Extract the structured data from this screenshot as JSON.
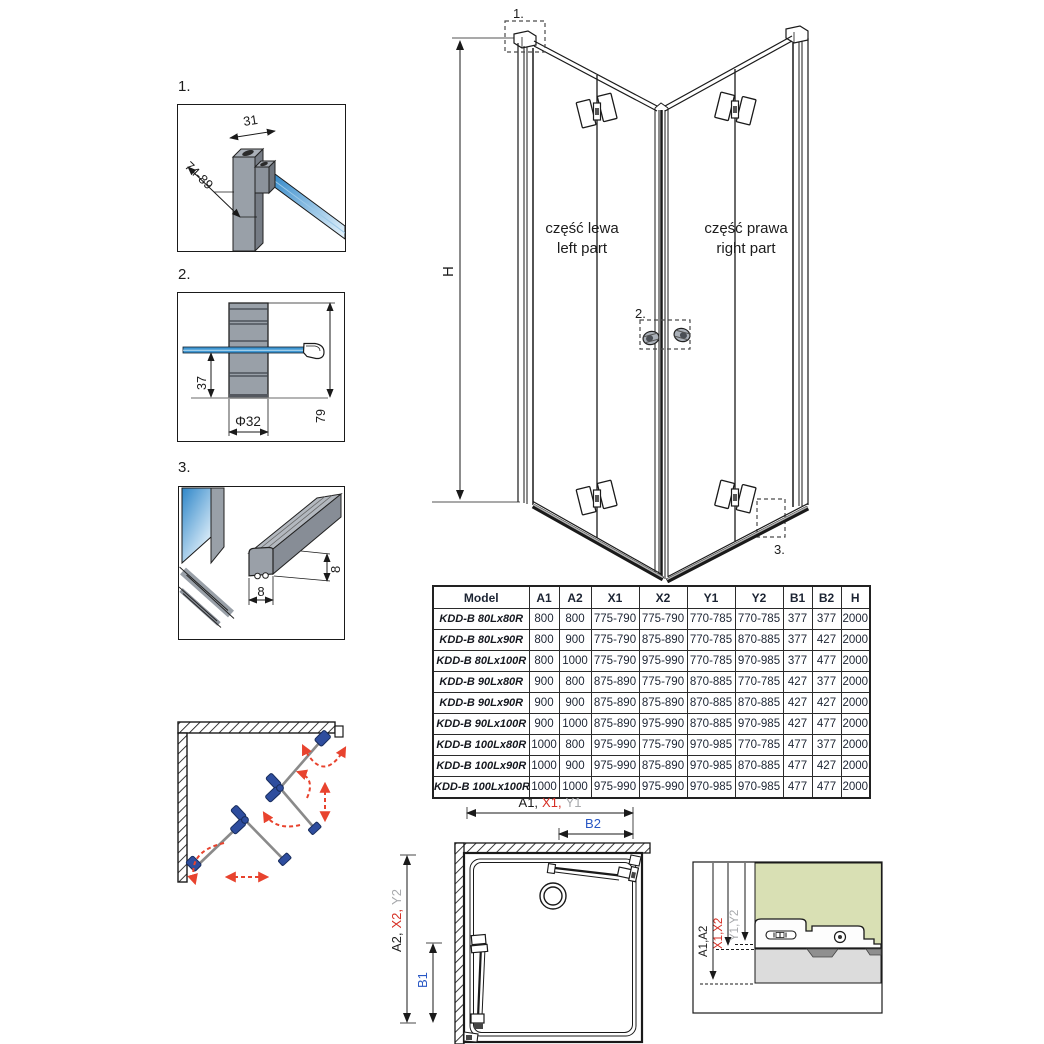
{
  "colors": {
    "line": "#1a1a1a",
    "red": "#d62e23",
    "blue": "#2857c4",
    "gray_label": "#a7a9ac",
    "profile": "#99a0a8",
    "profile_dark": "#767c85",
    "profile_light": "#b3b8bf",
    "glass": "#3f97d3",
    "glass_light": "#e8f4fc",
    "hinge_blue": "#2e4d9e",
    "arrow_red": "#e8432e",
    "green_bg": "#d9e0b4",
    "tray_gray": "#dcdcdc"
  },
  "details": {
    "d1": {
      "label": "1.",
      "dim_width": "31",
      "dim_range": "74-89"
    },
    "d2": {
      "label": "2.",
      "dim_offset": "37",
      "dim_diameter": "Φ32",
      "dim_height": "79"
    },
    "d3": {
      "label": "3.",
      "dim_h": "8",
      "dim_w": "8"
    }
  },
  "main_drawing": {
    "height_label": "H",
    "callout_1": "1.",
    "callout_2": "2.",
    "callout_3": "3.",
    "left_part_pl": "część lewa",
    "left_part_en": "left part",
    "right_part_pl": "część prawa",
    "right_part_en": "right part"
  },
  "table": {
    "columns": [
      {
        "label": "Model",
        "color": "black"
      },
      {
        "label": "A1",
        "color": "black"
      },
      {
        "label": "A2",
        "color": "black"
      },
      {
        "label": "X1",
        "color": "red"
      },
      {
        "label": "X2",
        "color": "red"
      },
      {
        "label": "Y1",
        "color": "gray"
      },
      {
        "label": "Y2",
        "color": "gray"
      },
      {
        "label": "B1",
        "color": "blue"
      },
      {
        "label": "B2",
        "color": "blue"
      },
      {
        "label": "H",
        "color": "black"
      }
    ],
    "rows": [
      [
        "KDD-B 80Lx80R",
        "800",
        "800",
        "775-790",
        "775-790",
        "770-785",
        "770-785",
        "377",
        "377",
        "2000"
      ],
      [
        "KDD-B 80Lx90R",
        "800",
        "900",
        "775-790",
        "875-890",
        "770-785",
        "870-885",
        "377",
        "427",
        "2000"
      ],
      [
        "KDD-B 80Lx100R",
        "800",
        "1000",
        "775-790",
        "975-990",
        "770-785",
        "970-985",
        "377",
        "477",
        "2000"
      ],
      [
        "KDD-B 90Lx80R",
        "900",
        "800",
        "875-890",
        "775-790",
        "870-885",
        "770-785",
        "427",
        "377",
        "2000"
      ],
      [
        "KDD-B 90Lx90R",
        "900",
        "900",
        "875-890",
        "875-890",
        "870-885",
        "870-885",
        "427",
        "427",
        "2000"
      ],
      [
        "KDD-B 90Lx100R",
        "900",
        "1000",
        "875-890",
        "975-990",
        "870-885",
        "970-985",
        "427",
        "477",
        "2000"
      ],
      [
        "KDD-B 100Lx80R",
        "1000",
        "800",
        "975-990",
        "775-790",
        "970-985",
        "770-785",
        "477",
        "377",
        "2000"
      ],
      [
        "KDD-B 100Lx90R",
        "1000",
        "900",
        "975-990",
        "875-890",
        "970-985",
        "870-885",
        "477",
        "427",
        "2000"
      ],
      [
        "KDD-B 100Lx100R",
        "1000",
        "1000",
        "975-990",
        "975-990",
        "970-985",
        "970-985",
        "477",
        "477",
        "2000"
      ]
    ]
  },
  "plan_view": {
    "dim_a1": "A1,",
    "dim_x1": "X1,",
    "dim_y1": "Y1",
    "dim_b2": "B2",
    "dim_a2": "A2,",
    "dim_x2": "X2,",
    "dim_y2": "Y2",
    "dim_b1": "B1"
  },
  "section_detail": {
    "dim_a": "A1,A2",
    "dim_x": "X1,X2",
    "dim_y": "Y1,Y2"
  }
}
